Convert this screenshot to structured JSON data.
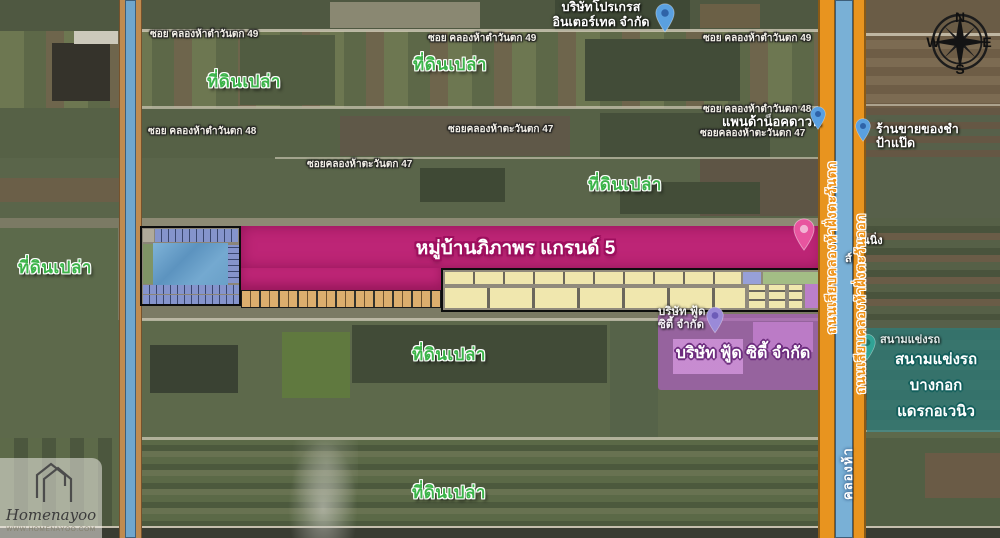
{
  "map": {
    "empty_land_label": "ที่ดินเปล่า",
    "village_title": "หมู่บ้านภิภาพร แกรนด์ 5",
    "roads": {
      "soi49": "ซอย คลองห้าตำวันตก 49",
      "soi48": "ซอย คลองห้าตำวันตก 48",
      "soi47": "ซอยคลองห้าตะวันตก 47",
      "west_road": "ถนนเลียบคลองห้าฝั่งตะวันตก",
      "east_road": "ถนนเลียบคลองห้าฝั่งตะวันออก",
      "canal_name": "คลองห้า"
    },
    "places": {
      "progress_line1": "บริษัทโปรเกรส",
      "progress_line2": "อินเตอร์เทค จำกัด",
      "panda": "แพนด้าน็อคดาวน์",
      "grocery_line1": "ร้านขายของชำ",
      "grocery_line2": "ป้าแป๊ด",
      "foodcity_small_line1": "บริษัท ฟู้ด",
      "foodcity_small_line2": "ซิตี้ จำกัด",
      "foodcity_title": "บริษัท ฟู้ด ซิตี้ จำกัด",
      "dragstrip_small": "สนามแข่งรถ",
      "dragstrip_line1": "สนามแข่งรถ",
      "dragstrip_line2": "บางกอก",
      "dragstrip_line3": "แดรกอเวนิว",
      "partial_text_1": "วันนิ่ง",
      "partial_text_2": "ส์"
    },
    "compass": {
      "n": "N",
      "e": "E",
      "s": "S",
      "w": "W"
    },
    "watermark": {
      "brand": "Homenayoo",
      "url": "WWW.HOMENAYOO.COM"
    },
    "colors": {
      "empty_land_green": "#3cb44a",
      "village_pink": "#bd2576",
      "foodcity_purple": "#a45fb2",
      "dragstrip_teal": "#2a7d7d",
      "road_orange": "#e8941f",
      "canal_blue": "#79b0d6"
    }
  }
}
